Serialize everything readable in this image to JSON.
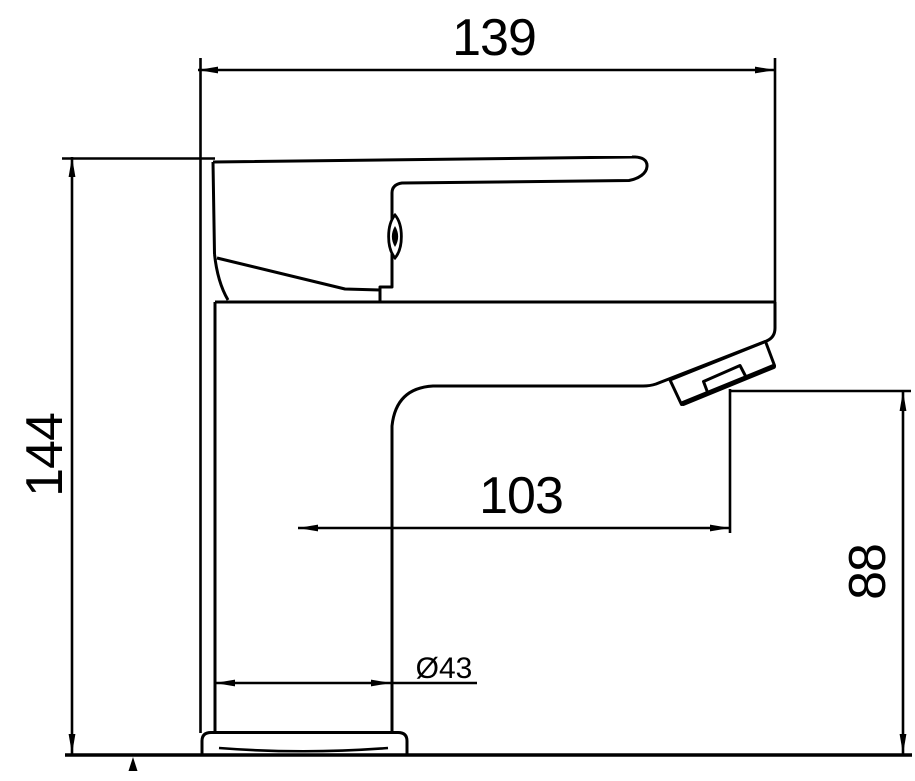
{
  "page": {
    "background_color": "#ffffff",
    "ink_color": "#000000"
  },
  "diagram": {
    "type": "technical-dimension-drawing",
    "subject": "single-lever basin faucet, side elevation",
    "dimensions": [
      {
        "id": "overall-length",
        "label": "139",
        "orientation": "horizontal"
      },
      {
        "id": "overall-height",
        "label": "144",
        "orientation": "vertical"
      },
      {
        "id": "spout-reach",
        "label": "103",
        "orientation": "horizontal"
      },
      {
        "id": "spout-height",
        "label": "88",
        "orientation": "vertical"
      },
      {
        "id": "base-diameter",
        "label": "Ø43",
        "orientation": "horizontal"
      }
    ]
  }
}
